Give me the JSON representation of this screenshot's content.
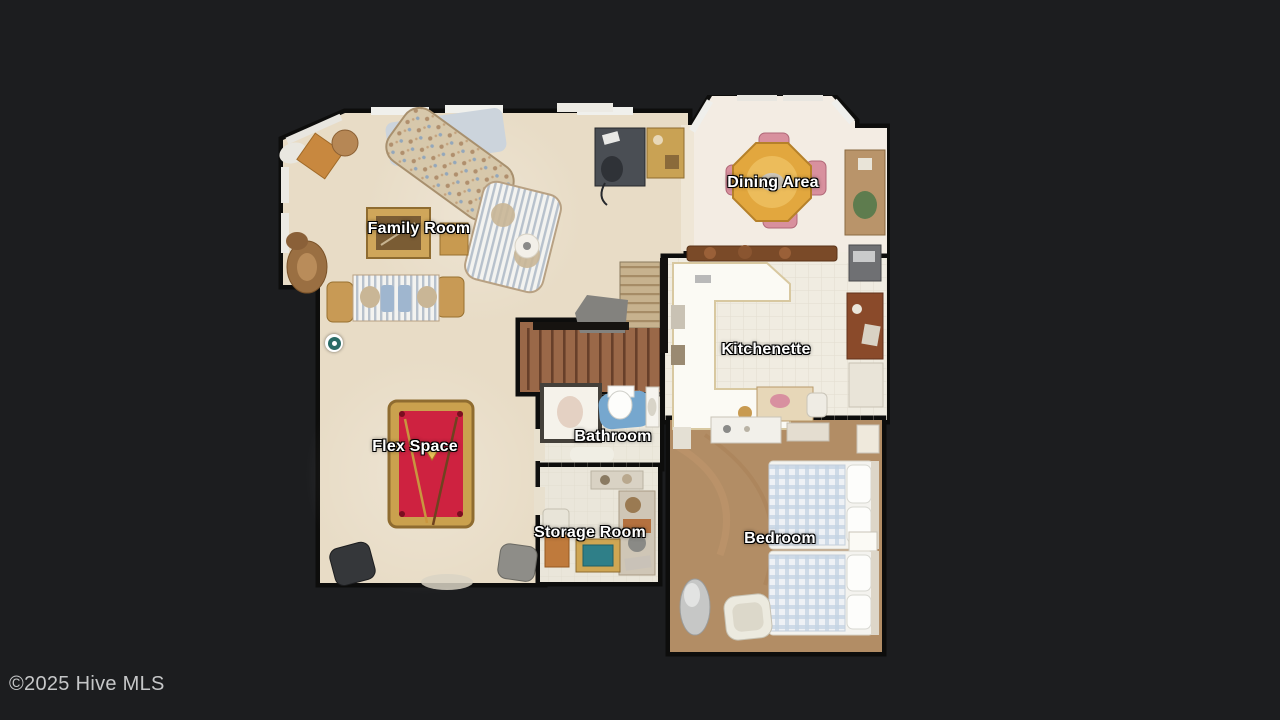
{
  "viewer": {
    "watermark": "©2025 Hive MLS"
  },
  "floorplan": {
    "rooms": [
      {
        "id": "family-room",
        "label": "Family Room"
      },
      {
        "id": "dining-area",
        "label": "Dining Area"
      },
      {
        "id": "kitchenette",
        "label": "Kitchenette"
      },
      {
        "id": "bathroom",
        "label": "Bathroom"
      },
      {
        "id": "flex-space",
        "label": "Flex Space"
      },
      {
        "id": "storage-room",
        "label": "Storage Room"
      },
      {
        "id": "bedroom",
        "label": "Bedroom"
      }
    ],
    "marker": {
      "type": "camera-position",
      "ring_color": "#2a6b66",
      "center_color": "#ffffff"
    }
  },
  "palette": {
    "background": "#1c1d1f",
    "walls": "#0d0d0c",
    "carpet": "#e8dcc6",
    "dining_marble": "#f3ece3",
    "kitchen_tile": "#f0ece1",
    "bath_tile": "#ece8dc",
    "storage_tile": "#eae6da",
    "bedroom_carpet": "#b28d65",
    "stairs": "#9a6848",
    "pool_table_felt": "#ce2240",
    "pool_table_rail": "#caa14e",
    "label_text": "#ffffff",
    "watermark_text": "#c6c7c8"
  }
}
